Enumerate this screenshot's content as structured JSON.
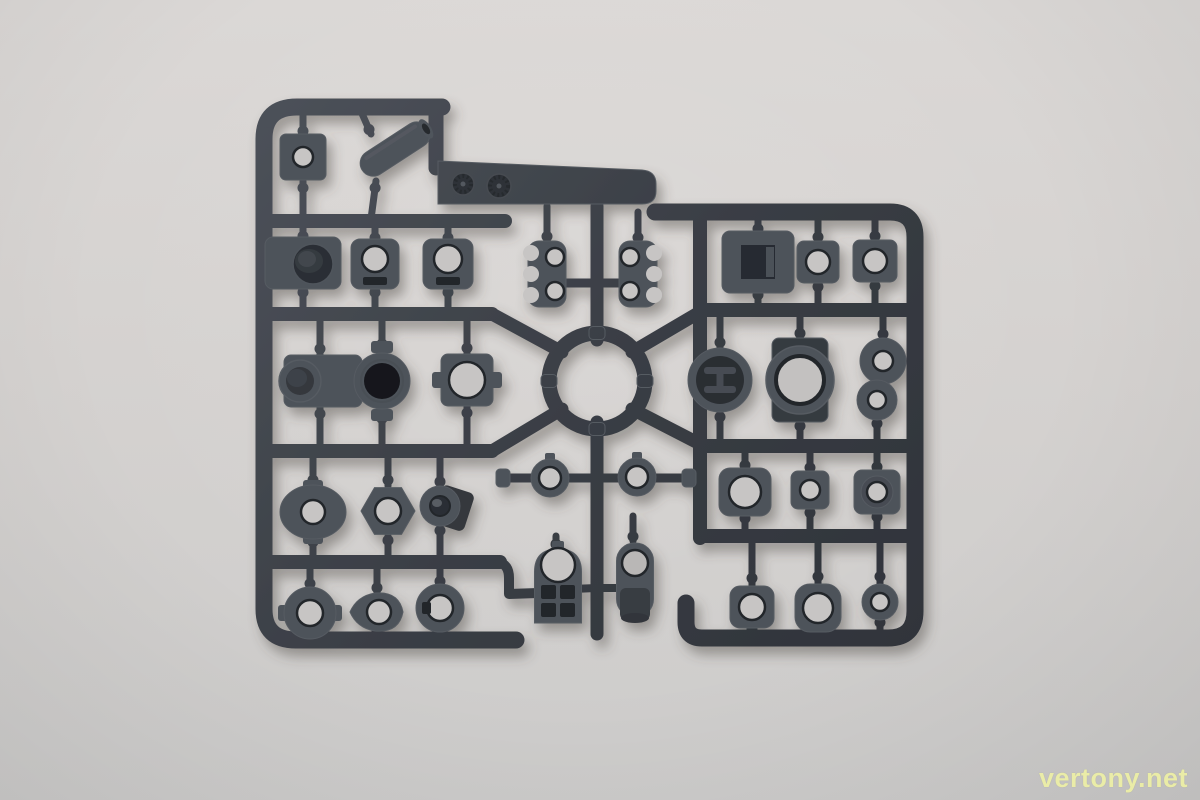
{
  "scene": {
    "description": "Photograph of a dark gray plastic model-kit parts sprue (runner frame with molded parts) lying on a plain light gray surface",
    "colors": {
      "background_top": "#dbd8d6",
      "background_bottom": "#cdcccb",
      "plastic_light": "#4d525a",
      "plastic_mid": "#3a3e45",
      "plastic_dark": "#2f333a",
      "part_edge": "#565b62",
      "hole_through": "#c7c5c4",
      "recess_dark": "#23262b",
      "recess_mid": "#2e3237",
      "shadow": "#4a4542"
    }
  },
  "watermark": {
    "text": "vertony.net",
    "color": "#eef0a6"
  },
  "sprue": {
    "runners": [
      {
        "name": "runner-frame-left",
        "d": "M 442,107 L 297,107 Q 264,107 264,139 L 264,609 Q 264,640 296,640 L 516,640",
        "w": 17
      },
      {
        "name": "runner-tab-link",
        "d": "M 436,107 L 436,168",
        "w": 15
      },
      {
        "name": "runner-frame-right",
        "d": "M 655,212 L 890,212 Q 915,212 915,237 L 915,611 Q 915,638 888,638 L 702,638 Q 686,638 686,622 L 686,603",
        "w": 17
      },
      {
        "name": "runner-rail-left-1",
        "d": "M 264,221 L 505,221",
        "w": 14
      },
      {
        "name": "runner-rail-left-2",
        "d": "M 264,314 L 492,314",
        "w": 14
      },
      {
        "name": "runner-rail-left-3",
        "d": "M 264,451 L 492,451",
        "w": 14
      },
      {
        "name": "runner-rail-left-4",
        "d": "M 264,562 L 500,562",
        "w": 14
      },
      {
        "name": "runner-stub-left-4",
        "d": "M 498,562 Q 509,564 509,578 L 509,594 L 538,593",
        "w": 10
      },
      {
        "name": "runner-rail-right-vertical",
        "d": "M 700,212 L 700,538",
        "w": 14
      },
      {
        "name": "runner-rail-right-2",
        "d": "M 700,310 L 915,310",
        "w": 14
      },
      {
        "name": "runner-rail-right-3",
        "d": "M 700,446 L 915,446",
        "w": 14
      },
      {
        "name": "runner-rail-right-4",
        "d": "M 700,536 L 915,536",
        "w": 14
      },
      {
        "name": "runner-diagonal-nw",
        "d": "M 492,314 L 562,352",
        "w": 13
      },
      {
        "name": "runner-diagonal-sw",
        "d": "M 492,451 L 562,409",
        "w": 13
      },
      {
        "name": "runner-diagonal-ne",
        "d": "M 700,312 L 632,352",
        "w": 13
      },
      {
        "name": "runner-diagonal-se",
        "d": "M 700,444 L 632,409",
        "w": 13
      },
      {
        "name": "runner-center-top",
        "d": "M 597,206 L 597,340",
        "w": 13
      },
      {
        "name": "runner-comb-bar",
        "d": "M 548,283 L 646,283",
        "w": 9
      },
      {
        "name": "runner-center-mid",
        "d": "M 597,422 L 597,520",
        "w": 13
      },
      {
        "name": "runner-collar-bar",
        "d": "M 504,478 L 688,478",
        "w": 9
      },
      {
        "name": "runner-center-bottom",
        "d": "M 597,520 L 597,634",
        "w": 13
      },
      {
        "name": "runner-gate-tombstone",
        "d": "M 597,588 L 572,589",
        "w": 8
      },
      {
        "name": "runner-gate-rodend",
        "d": "M 597,588 L 620,588",
        "w": 8
      }
    ],
    "stems": [
      [
        303,
        109,
        303,
        136
      ],
      [
        303,
        219,
        303,
        181
      ],
      [
        360,
        109,
        371,
        134
      ],
      [
        371,
        219,
        376,
        181
      ],
      [
        303,
        223,
        303,
        239
      ],
      [
        303,
        312,
        303,
        288
      ],
      [
        375,
        223,
        375,
        241
      ],
      [
        375,
        312,
        375,
        288
      ],
      [
        448,
        223,
        448,
        241
      ],
      [
        448,
        312,
        448,
        288
      ],
      [
        320,
        316,
        320,
        356
      ],
      [
        320,
        449,
        320,
        406
      ],
      [
        382,
        316,
        382,
        350
      ],
      [
        382,
        449,
        382,
        412
      ],
      [
        467,
        316,
        467,
        355
      ],
      [
        467,
        449,
        467,
        405
      ],
      [
        313,
        453,
        313,
        486
      ],
      [
        313,
        560,
        313,
        538
      ],
      [
        388,
        453,
        388,
        486
      ],
      [
        388,
        560,
        388,
        536
      ],
      [
        440,
        453,
        440,
        488
      ],
      [
        440,
        560,
        440,
        524
      ],
      [
        310,
        564,
        310,
        588
      ],
      [
        310,
        638,
        310,
        634
      ],
      [
        377,
        564,
        377,
        593
      ],
      [
        377,
        638,
        377,
        630
      ],
      [
        440,
        564,
        440,
        585
      ],
      [
        440,
        638,
        440,
        630
      ],
      [
        547,
        206,
        547,
        243
      ],
      [
        638,
        212,
        638,
        243
      ],
      [
        556,
        536,
        556,
        546
      ],
      [
        633,
        516,
        633,
        541
      ],
      [
        758,
        214,
        758,
        232
      ],
      [
        758,
        308,
        758,
        292
      ],
      [
        818,
        214,
        818,
        242
      ],
      [
        818,
        308,
        818,
        282
      ],
      [
        875,
        214,
        875,
        241
      ],
      [
        875,
        308,
        875,
        281
      ],
      [
        720,
        312,
        720,
        349
      ],
      [
        720,
        444,
        720,
        411
      ],
      [
        800,
        312,
        800,
        338
      ],
      [
        800,
        444,
        800,
        422
      ],
      [
        883,
        312,
        883,
        339
      ],
      [
        877,
        444,
        877,
        419
      ],
      [
        745,
        448,
        745,
        469
      ],
      [
        745,
        534,
        745,
        515
      ],
      [
        810,
        448,
        810,
        472
      ],
      [
        810,
        534,
        810,
        508
      ],
      [
        877,
        448,
        877,
        471
      ],
      [
        877,
        534,
        877,
        513
      ],
      [
        752,
        538,
        752,
        587
      ],
      [
        752,
        638,
        752,
        627
      ],
      [
        818,
        538,
        818,
        585
      ],
      [
        818,
        638,
        818,
        631
      ],
      [
        880,
        538,
        880,
        585
      ],
      [
        880,
        638,
        880,
        619
      ]
    ],
    "parts": [
      {
        "name": "mold-tab-plate",
        "kind": "tabplate",
        "cx": 0,
        "cy": 0,
        "p": {}
      },
      {
        "name": "center-ring-hub",
        "kind": "ringhub",
        "cx": 597,
        "cy": 381,
        "p": {}
      },
      {
        "name": "part-square-bushing",
        "kind": "block",
        "cx": 303,
        "cy": 157,
        "p": {
          "w": 46,
          "h": 46,
          "rx": 6,
          "hole": 10,
          "holeFill": "through"
        }
      },
      {
        "name": "part-angled-tube",
        "kind": "tube",
        "cx": 395,
        "cy": 149,
        "p": {
          "len": 78,
          "r": 13,
          "angle": -33
        }
      },
      {
        "name": "part-recess-block",
        "kind": "recessblock",
        "cx": 303,
        "cy": 263,
        "p": {
          "w": 76,
          "h": 52,
          "rx": 8
        }
      },
      {
        "name": "part-slot-block-1",
        "kind": "block",
        "cx": 375,
        "cy": 264,
        "p": {
          "w": 48,
          "h": 50,
          "rx": 9,
          "hole": 13,
          "holeFill": "through",
          "slot": true
        }
      },
      {
        "name": "part-slot-block-2",
        "kind": "block",
        "cx": 448,
        "cy": 264,
        "p": {
          "w": 50,
          "h": 50,
          "rx": 9,
          "hole": 14,
          "holeFill": "through",
          "slot": true
        }
      },
      {
        "name": "part-cylinder-block",
        "kind": "cylblock",
        "cx": 320,
        "cy": 381,
        "p": {}
      },
      {
        "name": "part-dark-bore-ring",
        "kind": "ringtab",
        "cx": 382,
        "cy": 381,
        "p": {}
      },
      {
        "name": "part-through-block",
        "kind": "block",
        "cx": 467,
        "cy": 380,
        "p": {
          "w": 52,
          "h": 52,
          "rx": 7,
          "hole": 18,
          "holeFill": "through",
          "sideTabs": true
        }
      },
      {
        "name": "part-flanged-collar",
        "kind": "collar",
        "cx": 313,
        "cy": 512,
        "p": {
          "rx": 33,
          "ry": 27,
          "hole": 12
        }
      },
      {
        "name": "part-hex-nut",
        "kind": "hex",
        "cx": 388,
        "cy": 511,
        "p": {
          "R": 27,
          "hole": 13
        }
      },
      {
        "name": "part-angled-cylinder",
        "kind": "flangecyl",
        "cx": 440,
        "cy": 506,
        "p": {
          "R": 20,
          "hole": 10
        }
      },
      {
        "name": "part-round-collar",
        "kind": "ring",
        "cx": 310,
        "cy": 613,
        "p": {
          "R": 26,
          "hole": 13,
          "tabs": true
        }
      },
      {
        "name": "part-teardrop-eyelet",
        "kind": "teardrop",
        "cx": 377,
        "cy": 612,
        "p": {
          "hole": 12
        }
      },
      {
        "name": "part-keyed-ring",
        "kind": "ring",
        "cx": 440,
        "cy": 608,
        "p": {
          "R": 24,
          "hole": 13,
          "key": true
        }
      },
      {
        "name": "part-claw-comb-left",
        "kind": "comb",
        "cx": 547,
        "cy": 274,
        "p": {
          "flip": 1
        }
      },
      {
        "name": "part-claw-comb-right",
        "kind": "comb",
        "cx": 638,
        "cy": 274,
        "p": {
          "flip": -1
        }
      },
      {
        "name": "part-collar-ring-left",
        "kind": "ring",
        "cx": 550,
        "cy": 478,
        "p": {
          "R": 19,
          "hole": 11,
          "nub": true
        }
      },
      {
        "name": "part-collar-ring-right",
        "kind": "ring",
        "cx": 637,
        "cy": 477,
        "p": {
          "R": 19,
          "hole": 11,
          "nub": true
        }
      },
      {
        "name": "runner-cap-left",
        "kind": "cap",
        "cx": 503,
        "cy": 478,
        "p": {
          "w": 14,
          "h": 18
        }
      },
      {
        "name": "runner-cap-right",
        "kind": "cap",
        "cx": 689,
        "cy": 478,
        "p": {
          "w": 14,
          "h": 18
        }
      },
      {
        "name": "part-grid-bracket",
        "kind": "tombstone",
        "cx": 558,
        "cy": 583,
        "p": {}
      },
      {
        "name": "part-rod-end",
        "kind": "rodend",
        "cx": 635,
        "cy": 580,
        "p": {}
      },
      {
        "name": "part-square-frame",
        "kind": "squareframe",
        "cx": 758,
        "cy": 262,
        "p": {
          "w": 72,
          "h": 62,
          "inner": 34
        }
      },
      {
        "name": "part-square-bushing-2",
        "kind": "block",
        "cx": 818,
        "cy": 262,
        "p": {
          "w": 42,
          "h": 42,
          "rx": 7,
          "hole": 12,
          "holeFill": "through"
        }
      },
      {
        "name": "part-square-bushing-3",
        "kind": "block",
        "cx": 875,
        "cy": 261,
        "p": {
          "w": 44,
          "h": 42,
          "rx": 7,
          "hole": 12,
          "holeFill": "through"
        }
      },
      {
        "name": "part-h-core-cylinder",
        "kind": "hcore",
        "cx": 720,
        "cy": 380,
        "p": {
          "R": 32
        }
      },
      {
        "name": "part-flanged-cylinder-large",
        "kind": "bigcyl",
        "cx": 800,
        "cy": 380,
        "p": {}
      },
      {
        "name": "part-double-cylinder",
        "kind": "doublecyl",
        "cx": 880,
        "cy": 380,
        "p": {}
      },
      {
        "name": "part-socket-block-large",
        "kind": "block",
        "cx": 745,
        "cy": 492,
        "p": {
          "w": 52,
          "h": 48,
          "rx": 11,
          "hole": 16,
          "holeFill": "through"
        }
      },
      {
        "name": "part-socket-block-small",
        "kind": "block",
        "cx": 810,
        "cy": 490,
        "p": {
          "w": 38,
          "h": 38,
          "rx": 7,
          "hole": 10,
          "holeFill": "through"
        }
      },
      {
        "name": "part-boss-block",
        "kind": "bossblock",
        "cx": 877,
        "cy": 492,
        "p": {
          "w": 46,
          "h": 44,
          "boss": 16,
          "hole": 10
        }
      },
      {
        "name": "part-d-bracket",
        "kind": "block",
        "cx": 752,
        "cy": 607,
        "p": {
          "w": 44,
          "h": 42,
          "rx": 10,
          "hole": 13,
          "holeFill": "through"
        }
      },
      {
        "name": "part-barrel-bushing",
        "kind": "block",
        "cx": 818,
        "cy": 608,
        "p": {
          "w": 46,
          "h": 48,
          "rx": 15,
          "hole": 15,
          "holeFill": "through"
        }
      },
      {
        "name": "part-small-ring",
        "kind": "ring",
        "cx": 880,
        "cy": 602,
        "p": {
          "R": 18,
          "hole": 9
        }
      }
    ]
  }
}
